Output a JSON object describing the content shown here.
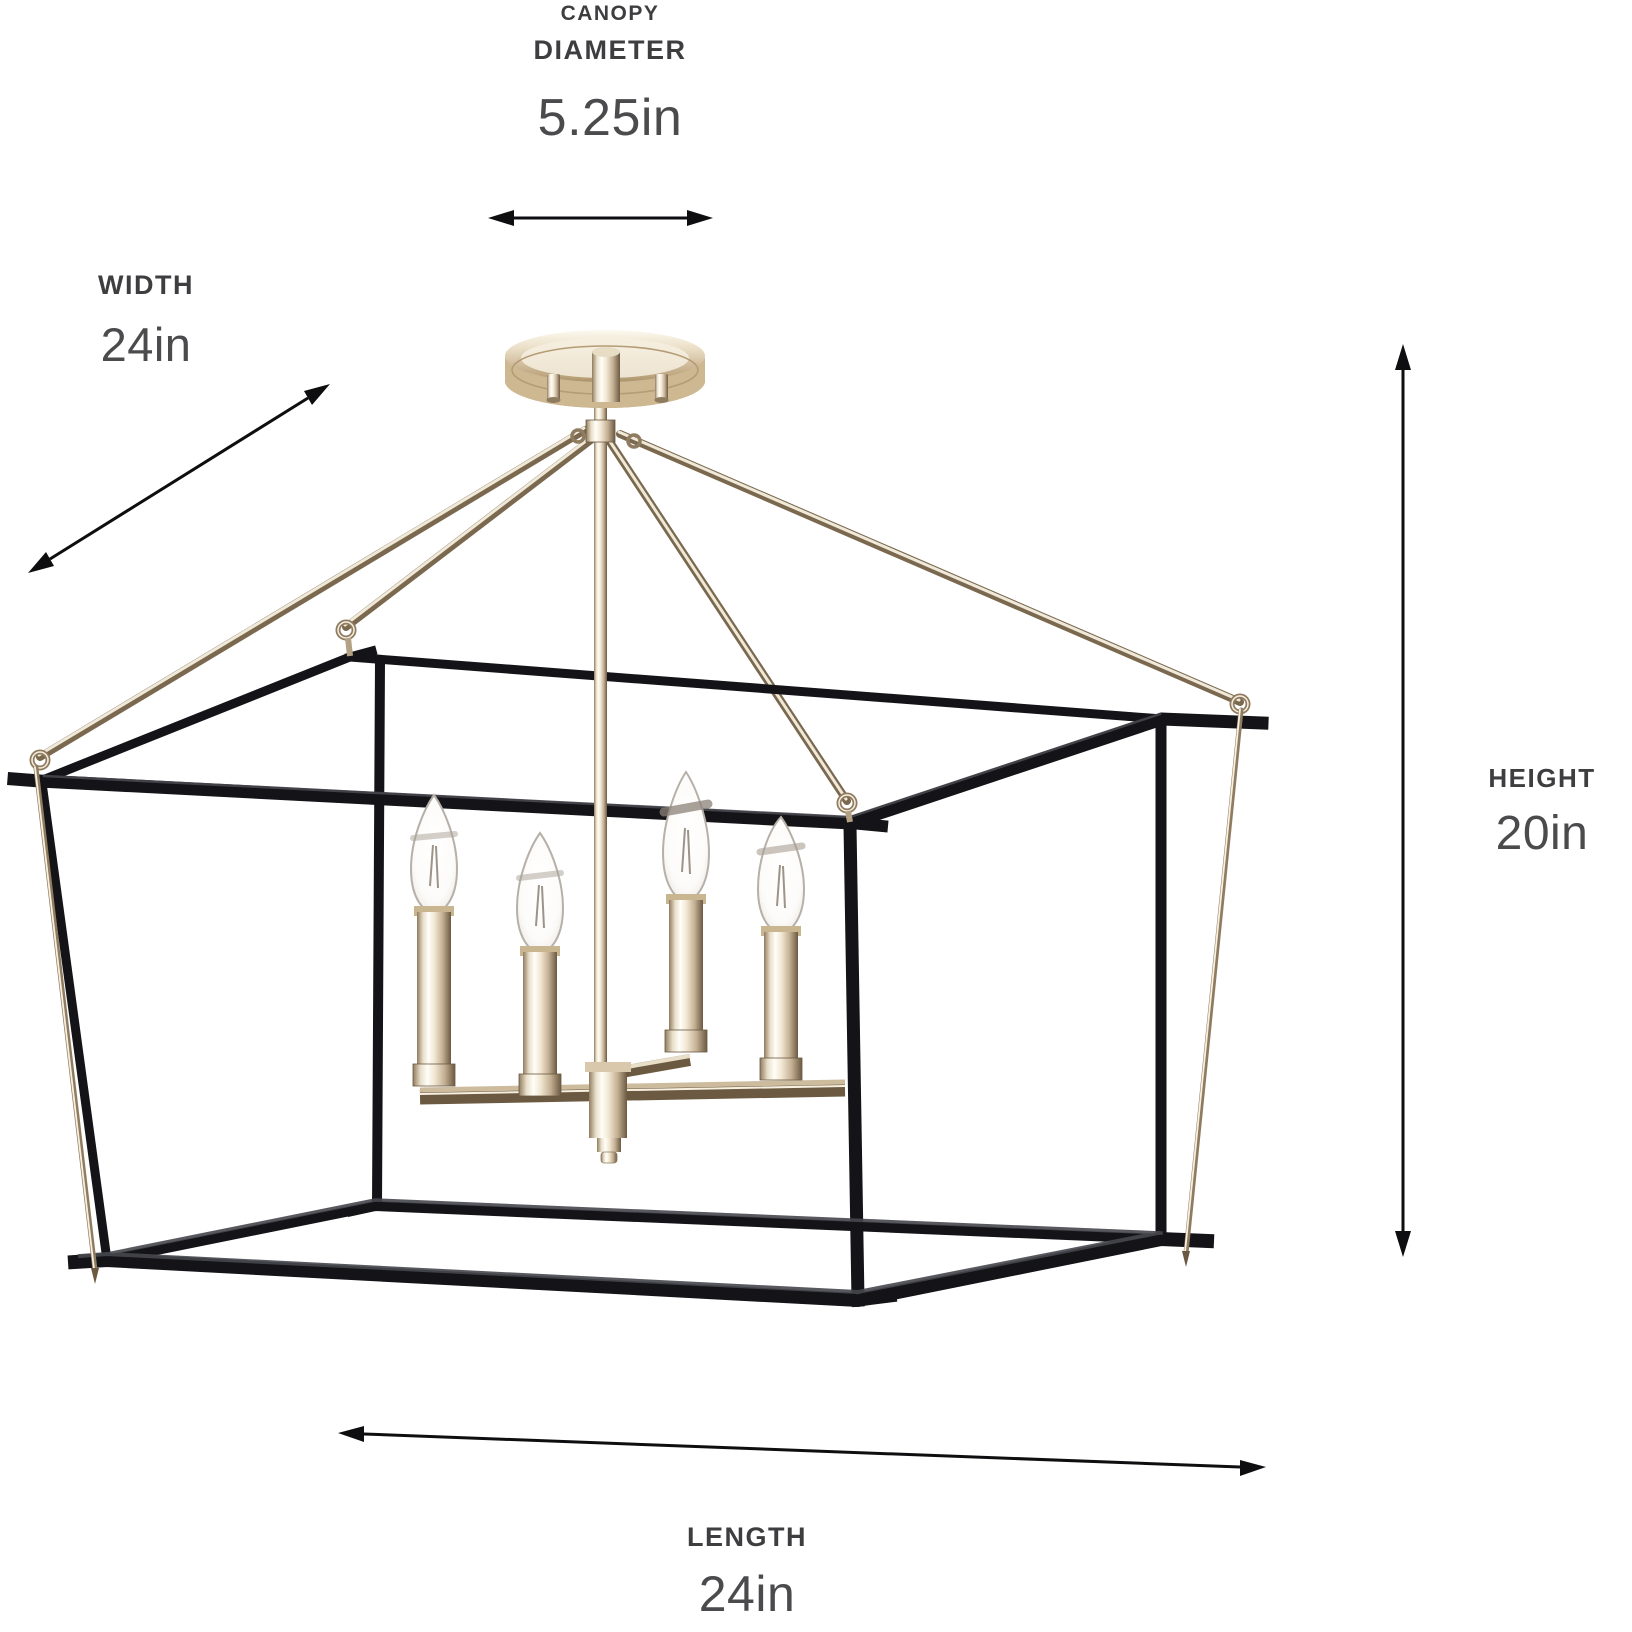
{
  "dimensions": {
    "canopy": {
      "label_line1": "CANOPY",
      "label_line2": "DIAMETER",
      "value": "5.25in"
    },
    "width": {
      "label": "WIDTH",
      "value": "24in"
    },
    "height": {
      "label": "HEIGHT",
      "value": "20in"
    },
    "length": {
      "label": "LENGTH",
      "value": "24in"
    }
  },
  "fixture": {
    "bulb_count": 4,
    "colors": {
      "frame_black": "#141418",
      "frame_highlight": "#46464e",
      "nickel_light": "#f7f0e0",
      "nickel_mid": "#d9c8ac",
      "nickel_dark": "#7a684f",
      "arrow": "#0e0e10",
      "label_text": "#3e3e40",
      "value_text": "#4b4b4d"
    }
  }
}
